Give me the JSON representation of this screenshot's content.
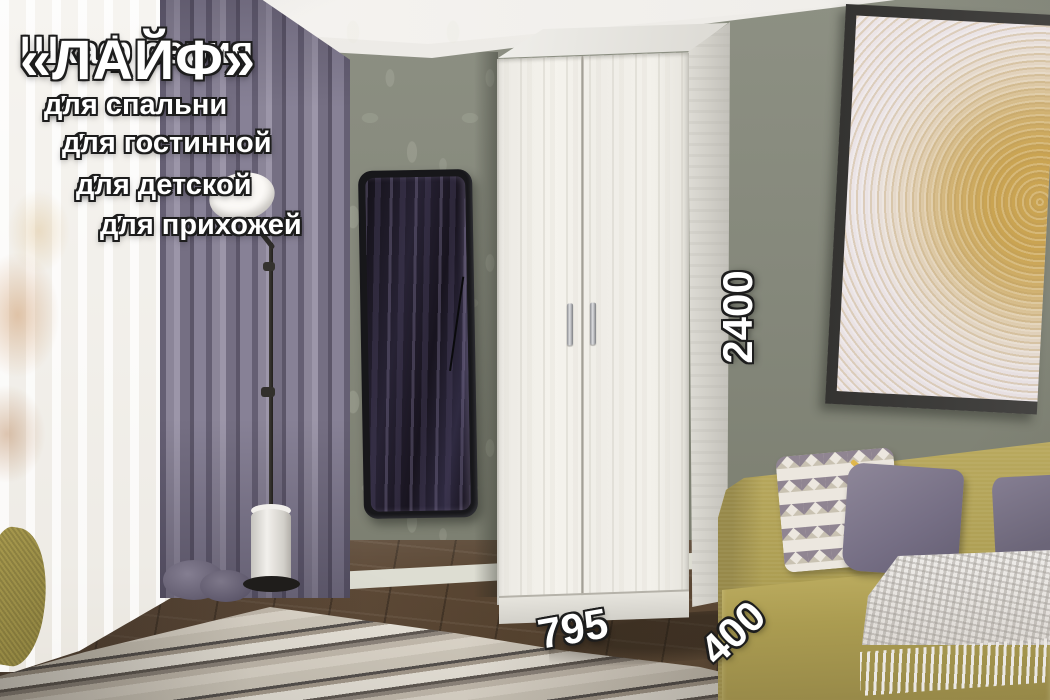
{
  "product_overlay": {
    "title_prefix": "Шкаф серия",
    "title_name": "«ЛАЙФ»",
    "check_icon": "✔",
    "features": [
      "для спальни",
      "для гостинной",
      "для детской",
      "для прихожей"
    ],
    "dimensions": {
      "height_mm": "2400",
      "width_mm": "795",
      "depth_mm": "400"
    }
  },
  "scene": {
    "colors": {
      "wall": "#84877a",
      "curtain": "#837d92",
      "sofa": "#b3a45a",
      "wardrobe": "#f1efe9",
      "floor": "#5f4c3c",
      "art_gold": "#caa452",
      "mirror_frame": "#17171a",
      "overlay_text": "#ffffff",
      "overlay_outline": "#1d1d1d"
    },
    "objects": [
      "window",
      "sheer-curtain",
      "curtains",
      "floor-lamp",
      "mirror",
      "wardrobe",
      "wall-art",
      "sofa",
      "pillows",
      "throw-blanket",
      "rug",
      "armchair-corner"
    ]
  }
}
